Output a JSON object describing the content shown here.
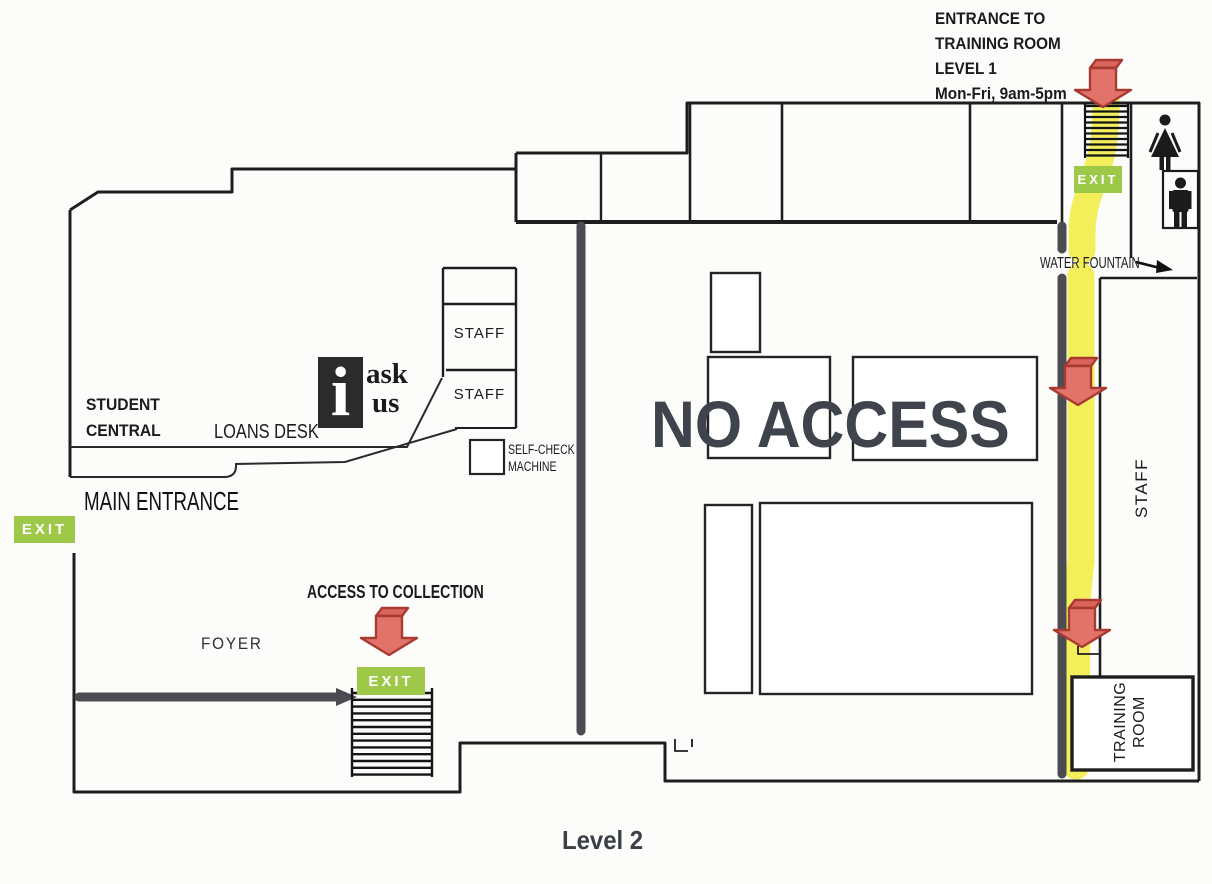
{
  "map": {
    "caption": "Level 2",
    "note_line1": "ENTRANCE TO",
    "note_line2": "TRAINING ROOM",
    "note_line3": "LEVEL 1",
    "note_line4": "Mon-Fri, 9am-5pm",
    "exit_label": "EXIT",
    "water_fountain_label": "WATER FOUNTAIN",
    "staff_label": "STAFF",
    "student_central_line1": "STUDENT",
    "student_central_line2": "CENTRAL",
    "loans_desk_label": "LOANS DESK",
    "info_i": "i",
    "info_ask": "ask",
    "info_us": "us",
    "self_check_line1": "SELF-CHECK",
    "self_check_line2": "MACHINE",
    "main_entrance_label": "MAIN ENTRANCE",
    "no_access_label": "NO ACCESS",
    "access_collection_label": "ACCESS TO COLLECTION",
    "foyer_label": "FOYER",
    "training_room_line1": "TRAINING",
    "training_room_line2": "ROOM"
  },
  "colors": {
    "exit_green": "#9dc848",
    "arrow_red_fill": "#e2736b",
    "arrow_red_outline": "#a83a31",
    "path_yellow": "#f0ed44",
    "wall_black": "#1e1e1e",
    "barrier_gray": "#4b4b52",
    "no_access_text": "#3f444c"
  }
}
